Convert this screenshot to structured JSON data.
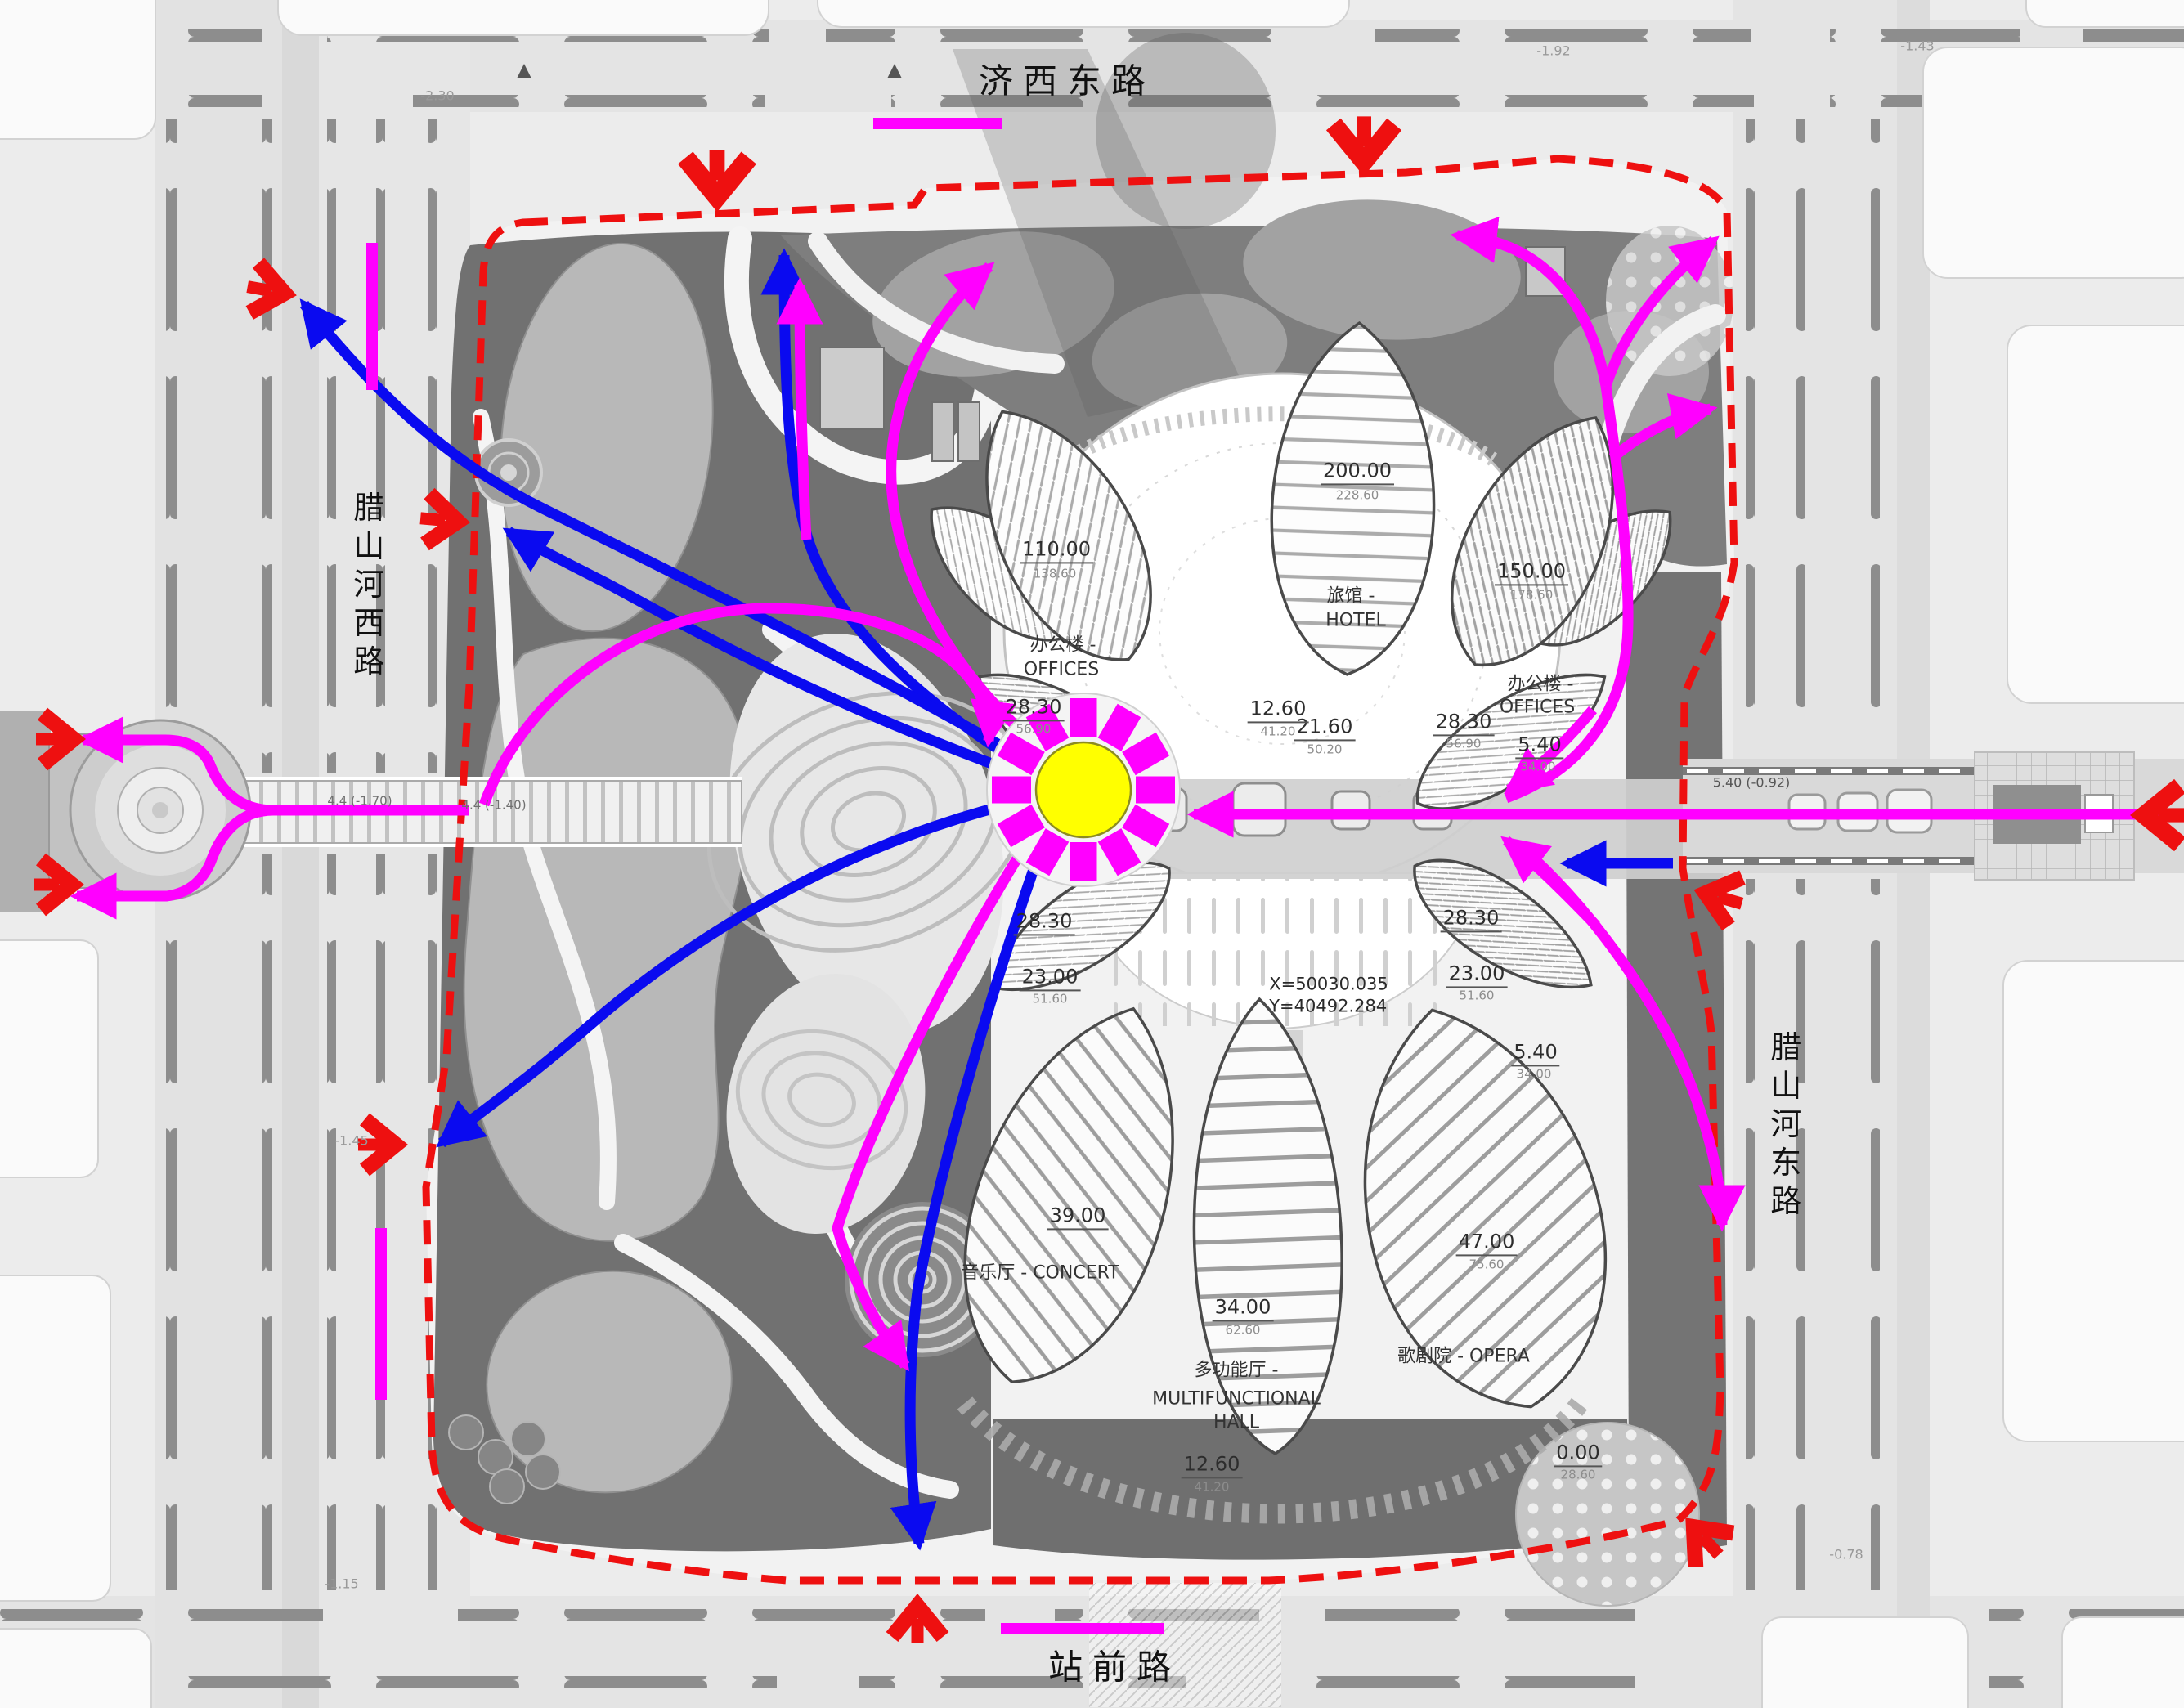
{
  "colors": {
    "magenta_flow": "#ff00ff",
    "blue_flow": "#0a0af0",
    "entry_marker_red": "#ee1010",
    "boundary_red": "#ee1010",
    "sun_yellow": "#ffff00"
  },
  "roads": {
    "top": "济西东路",
    "bottom": "站前路",
    "left": "腊山河西路",
    "right": "腊山河东路"
  },
  "labels": {
    "hotel_elev": "200.00",
    "hotel_sub": "228.60",
    "hotel_cn": "旅馆 -",
    "hotel_en": "HOTEL",
    "off_left_elev": "110.00",
    "off_left_sub": "138.60",
    "off_left_cn": "办公楼 -",
    "off_left_en": "OFFICES",
    "off_right_elev": "150.00",
    "off_right_sub": "178.60",
    "off_right_cn": "办公楼 -",
    "off_right_en": "OFFICES",
    "upper_plaza_elev": "21.60",
    "upper_plaza_sub": "50.20",
    "axis_elev": "12.60",
    "axis_sub": "41.20",
    "leaf_elev": "28.30",
    "leaf_sub": "56.90",
    "canopy_elev": "23.00",
    "canopy_sub": "51.60",
    "side_elev": "5.40",
    "side_sub": "34.00",
    "concert_elev": "39.00",
    "concert_name": "音乐厅 - CONCERT",
    "multi_elev": "34.00",
    "multi_sub": "62.60",
    "multi_cn": "多功能厅 -",
    "multi_en": "MULTIFUNCTIONAL\nHALL",
    "opera_elev": "47.00",
    "opera_sub": "75.60",
    "opera_name": "歌剧院 - OPERA",
    "lower_plaza_elev": "12.60",
    "lower_plaza_sub": "41.20",
    "zero_elev": "0.00",
    "zero_sub": "28.60",
    "coords": "X=50030.035\nY=40492.284",
    "station_elev": "5.40 (-0.92)",
    "bridge_left_1": "4.4 (-1.70)",
    "bridge_left_2": "4.4 (-1.40)",
    "spot_tl": "-2.30",
    "spot_t1": "-1.92",
    "spot_t2": "-1.43",
    "spot_bl": "-1.15",
    "spot_br": "-0.78",
    "spot_ml": "-1.45"
  }
}
